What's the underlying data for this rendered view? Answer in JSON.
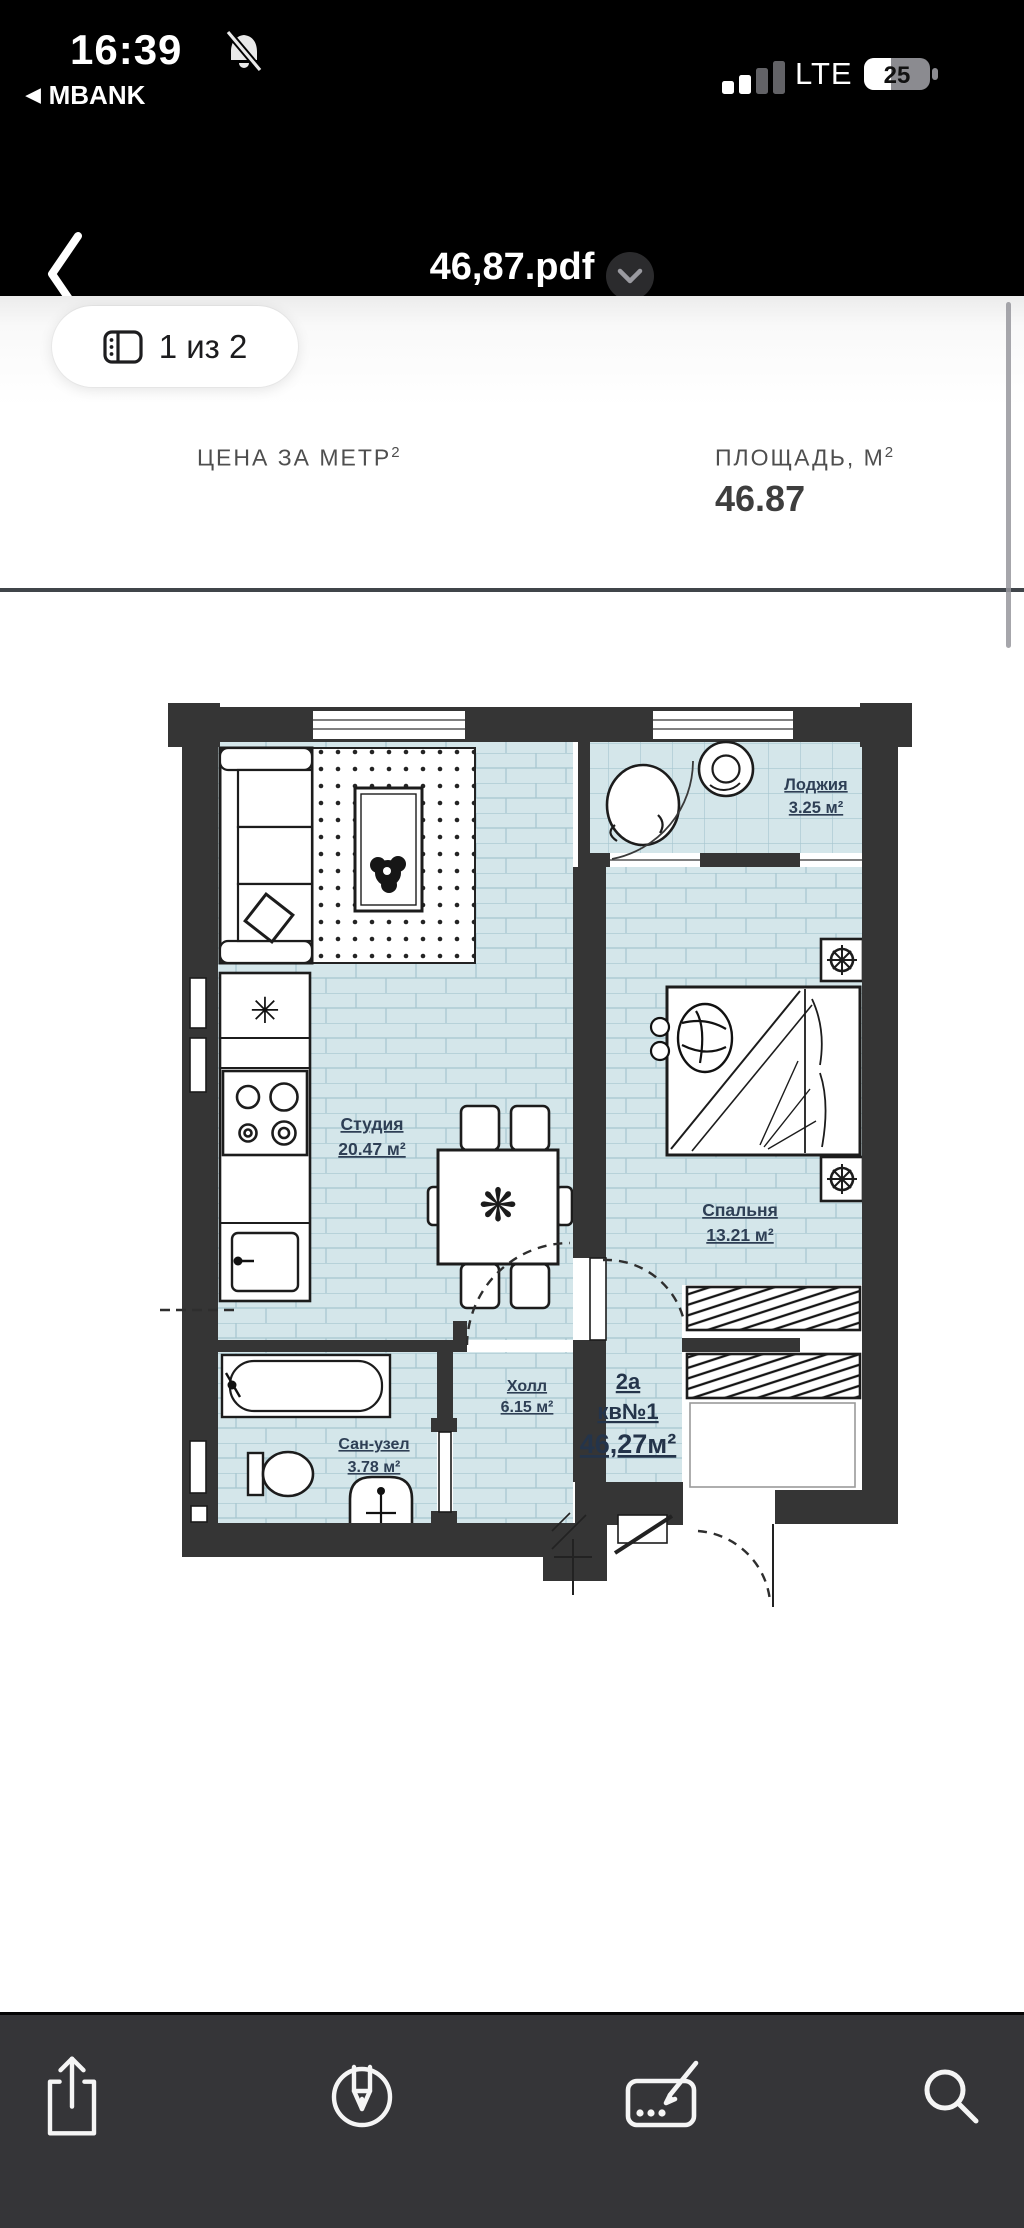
{
  "status_bar": {
    "time": "16:39",
    "back_to_app": "MBANK",
    "back_triangle": "◀",
    "network": "LTE",
    "battery_percent": "25",
    "signal_bars_total": 4,
    "signal_bars_lit": 2
  },
  "nav_bar": {
    "title": "46,87.pdf"
  },
  "page_indicator": {
    "label": "1 из 2"
  },
  "pdf_header": {
    "price_label": "ЦЕНА ЗА МЕТР",
    "price_sup": "2",
    "area_label": "ПЛОЩАДЬ, М",
    "area_sup": "2",
    "area_value": "46.87"
  },
  "floor_plan": {
    "rooms": [
      {
        "name": "Лоджия",
        "area": "3.25 м²"
      },
      {
        "name": "Студия",
        "area": "20.47 м²"
      },
      {
        "name": "Спальня",
        "area": "13.21 м²"
      },
      {
        "name": "Холл",
        "area": "6.15 м²"
      },
      {
        "name": "Сан-узел",
        "area": "3.78 м²"
      }
    ],
    "apartment": {
      "type": "2а",
      "number": "кв№1",
      "total_area": "46,27м²"
    }
  },
  "toolbar": {
    "icons": [
      "share",
      "markup",
      "signature",
      "search"
    ]
  },
  "colors": {
    "chrome_bg": "#000000",
    "toolbar_bg": "#353538",
    "wall": "#353535",
    "tile": "#d4e6ea",
    "tile_line": "#a6c6cf",
    "label_navy": "#2e3f55",
    "divider": "#40454a"
  }
}
